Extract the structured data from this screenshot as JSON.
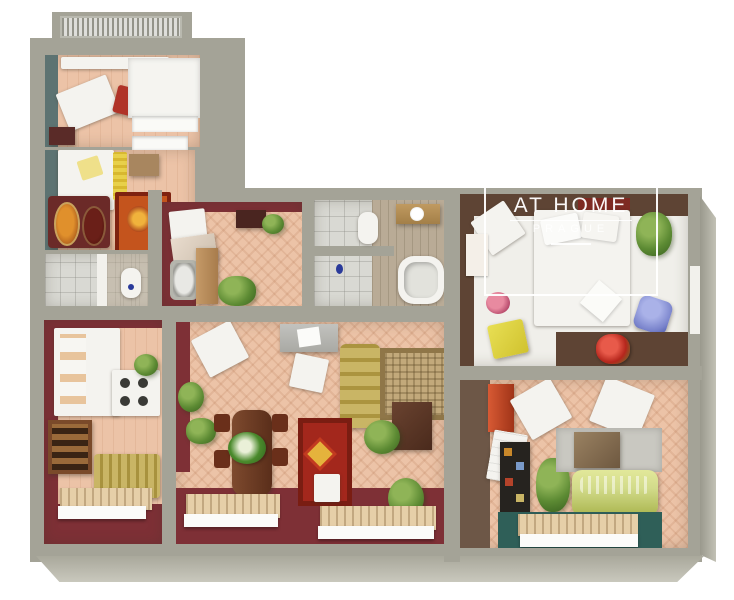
{
  "watermark": {
    "title": "AT HOME",
    "subtitle": "PRAGUE"
  },
  "colors": {
    "wall_outer": "#a4a397",
    "wall_maroon": "#7e3036",
    "wall_teal": "#5d7372",
    "wall_brown": "#5e4434",
    "floor_pink": "#ecc3a7",
    "floor_white": "#f0efea",
    "sofa_gold": "#c9b565",
    "sofa_green": "#d2db8a",
    "rug_red": "#a3271c",
    "rug_orange": "#c4541d",
    "rug_beige": "#c2a97b",
    "chair_blue": "#7a84cc",
    "stool_yellow": "#e8df54",
    "accent_red_chair": "#b03328",
    "mat_teal": "#2f5f58"
  }
}
